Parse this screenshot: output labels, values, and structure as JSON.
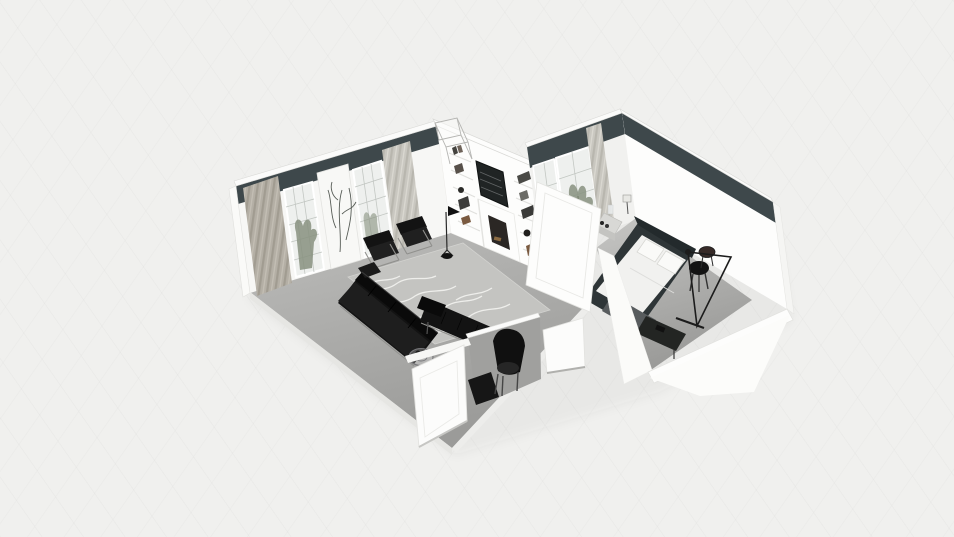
{
  "app": {
    "name": "3D floor plan viewer",
    "view_mode": "3D dollhouse isometric view",
    "background_texture": "light paper with faint diagonal grid"
  },
  "scene": {
    "rooms": [
      {
        "id": "living-room",
        "label": "Living room",
        "wall_features": [
          "dark slate accent band along wall tops",
          "beige pleated curtain",
          "gridded window with plant",
          "botanical line-art wall panel",
          "second gridded window",
          "sheer gray curtain",
          "built-in white shelving wall with books",
          "dark framed TV / art panel",
          "fireplace with white mantel",
          "glass transom box above divider wall"
        ],
        "furniture": [
          "black leather sofa with chrome base",
          "black lounge chair with chrome frame (left)",
          "black lounge chair with chrome frame (right)",
          "black daybed chaise",
          "black rounded armchair",
          "spider floor lamp",
          "round wire side table",
          "black media console",
          "gray marble-vein area rug",
          "open white door"
        ]
      },
      {
        "id": "bedroom",
        "label": "Bedroom",
        "wall_features": [
          "dark slate accent band along wall tops",
          "gridded window with tall plant",
          "gray pleated curtain",
          "white hallway door with panels"
        ],
        "furniture": [
          "double bed with dark frame and white bedding",
          "two white pillows",
          "gray throw blanket",
          "nightstand with table lamp and bottles",
          "black round stool",
          "dark round side table",
          "arc floor lamp with triangular frame",
          "dark media bench",
          "open white door"
        ]
      }
    ],
    "colors": {
      "background": "#f0f0ee",
      "band_dark": "#3e484b",
      "wall_white": "#f7f7f5",
      "wall_bright": "#fdfdfc",
      "wall_shaded": "#f1f1ef",
      "wall_front_gray": "#a0a09e",
      "wall_top": "#fbfbfa",
      "edge_light": "#dededb",
      "floor_light": "#b9b9b7",
      "floor_dark": "#989896",
      "bedroom_floor_light": "#c3c3c1",
      "bedroom_floor_dark": "#9a9a98",
      "rug": "#c4c4c1",
      "rug_vein": "#f1f1ee",
      "black_furniture": "#131313",
      "black_deep": "#0a0a0a",
      "black_soft": "#202020",
      "chrome": "#90908d",
      "curtain_beige": "#b4afa5",
      "curtain_beige_shade": "#a19c91",
      "curtain_light": "#c9c7c0",
      "curtain_light_shade": "#b8b6ae",
      "window_glass": "#eef0ee",
      "window_grid": "#c2c6c2",
      "plant_green": "#87917f",
      "plant_dark": "#6c765f",
      "art_line": "#3a403a",
      "tv_dark": "#202424",
      "fireplace_inner": "#2b2724",
      "log_brown": "#8a6a42",
      "wood_brown": "#7a5a40",
      "bed_frame": "#2e3537",
      "headboard": "#232a2c",
      "bedding": "#f1f1ef",
      "pillow": "#fafaf8",
      "blanket": "#585c5e",
      "bench_dark": "#232523",
      "nightstand": "#d8d8d5"
    }
  }
}
